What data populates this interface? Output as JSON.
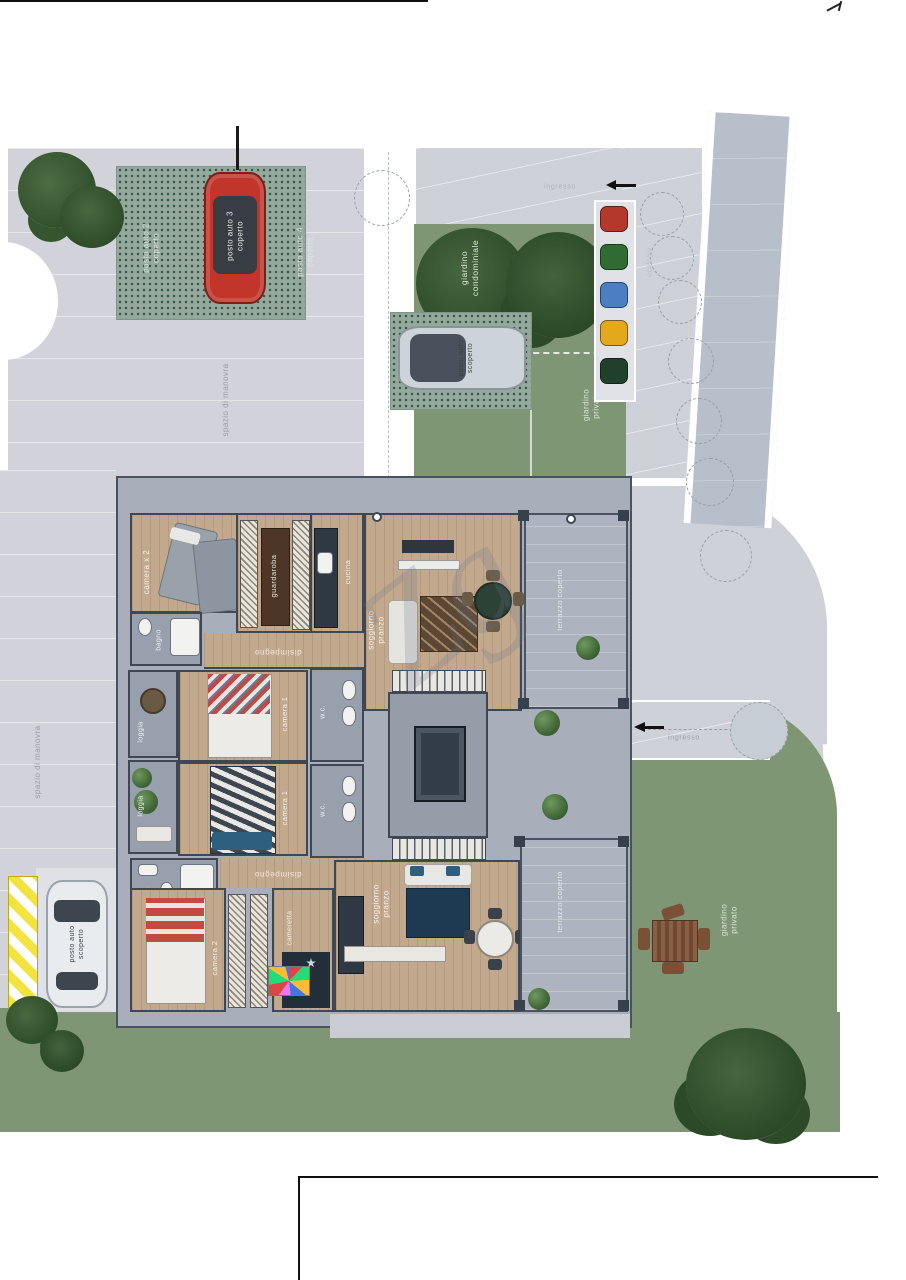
{
  "labels": {
    "parking": {
      "spot2": "posto auto 2\ncoperto",
      "spot3": "posto auto 3\ncoperto",
      "spot4": "posto auto 4\ncoperto",
      "silver": "posto auto\nscoperto",
      "white": "posto auto\nscoperto"
    },
    "site": {
      "condo_garden": "giardino\ncondominiale",
      "private_garden_upper": "giardino\nprivato",
      "private_garden_lower": "giardino\nprivato",
      "maneuver_1": "spazio di manovra",
      "maneuver_2": "spazio di manovra",
      "ecologia": "ecologia",
      "entrance_top": "ingresso",
      "entrance_mid": "ingresso"
    },
    "upper": {
      "camera2x": "camera x 2",
      "guardaroba": "guardaroba",
      "cucina": "cucina",
      "bagno": "bagno",
      "disimpegno": "disimpegno",
      "soggiorno": "soggiorno\npranzo",
      "terrazzo": "terrazzo coperto",
      "loggia": "loggia",
      "camera1": "camera 1",
      "wc": "w.c."
    },
    "lower": {
      "loggia": "loggia",
      "camera1": "camera 1",
      "wc": "w.c.",
      "bagno": "bagno",
      "disimpegno": "disimpegno",
      "camera2": "camera 2",
      "cameretta": "cameretta",
      "soggiorno": "soggiorno\npranzo",
      "terrazzo": "terrazzo coperto"
    },
    "watermark": "Zg"
  },
  "colors": {
    "grass": "#7e9674",
    "pavement": "#d2d3da",
    "road": "#b7bfca",
    "terrace": "#aeb4bf",
    "wood_floor": "#c2a88d",
    "wall": "#3d4854",
    "car_red": "#c1352a",
    "car_silver": "#ccd3d9",
    "car_white": "#e9ecef",
    "hatch_yellow": "#f2e340",
    "bins": [
      "#b5382c",
      "#2f6b33",
      "#4a7fc4",
      "#e3a81c",
      "#20402c"
    ]
  }
}
